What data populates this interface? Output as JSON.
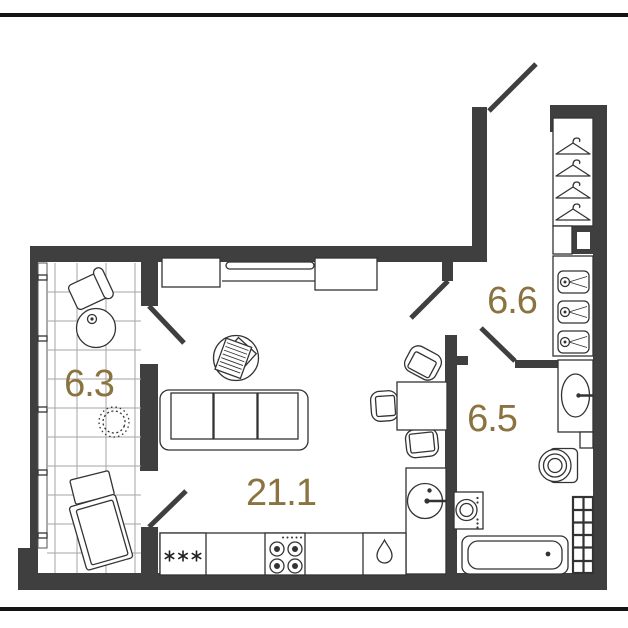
{
  "page": {
    "type": "apartment-floor-plan",
    "divider_top": true,
    "divider_bottom": true
  },
  "rooms": [
    {
      "name": "living-room-with-kitchen",
      "area_label": "21.1"
    },
    {
      "name": "balcony",
      "area_label": "6.3"
    },
    {
      "name": "hallway",
      "area_label": "6.6"
    },
    {
      "name": "bathroom",
      "area_label": "6.5"
    }
  ],
  "furniture": {
    "balcony": [
      "armchair",
      "side-table",
      "cup",
      "plant",
      "ottoman",
      "chaise-lounge",
      "tiled-floor-grid",
      "window-glazing"
    ],
    "living_room": [
      "cabinet-left",
      "tv",
      "cabinet-right",
      "coffee-table",
      "magazines",
      "sofa-3-seat",
      "dining-table",
      "chair",
      "chair",
      "chair"
    ],
    "kitchen": [
      "fridge-freezer",
      "stove-4-burner",
      "dishwasher",
      "round-sink"
    ],
    "hallway": [
      "wardrobe-with-hangers",
      "shelf-niche",
      "drawer-unit"
    ],
    "bathroom": [
      "washbasin-cabinet",
      "toilet",
      "washing-machine",
      "bathtub",
      "towel-rail-grid"
    ]
  },
  "doors": [
    "entrance-door",
    "hallway-to-living-door",
    "bathroom-door",
    "balcony-door-upper",
    "balcony-door-lower"
  ],
  "colors": {
    "background": "#ffffff",
    "wall": "#3f3f3f",
    "furniture_line": "#333333",
    "grid_line": "#a6a6a6",
    "label": "#8b7340",
    "rule_line": "#141414"
  }
}
